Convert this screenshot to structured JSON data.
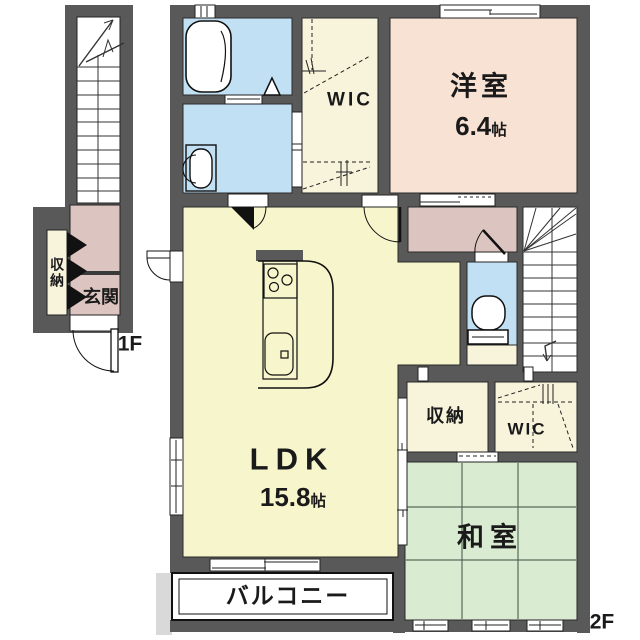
{
  "first_floor": {
    "floor_label": "1F",
    "entrance_label": "玄関",
    "storage_label": "収納"
  },
  "second_floor": {
    "floor_label": "2F",
    "western_room": {
      "name": "洋室",
      "size": "6.4",
      "size_unit": "帖"
    },
    "ldk": {
      "name": "LDK",
      "size": "15.8",
      "size_unit": "帖"
    },
    "japanese_room": {
      "name": "和室"
    },
    "balcony": {
      "name": "バルコニー"
    },
    "walk_in_closet_top": {
      "name": "WIC"
    },
    "walk_in_closet_right": {
      "name": "WIC"
    },
    "storage_label": "収納"
  },
  "colors": {
    "wall": "#595959",
    "water_rooms": "#c2e0f4",
    "ldk_floor": "#f7f5cc",
    "closet_floor": "#f8f4dc",
    "western_room_floor": "#f8e2d4",
    "hallway_floor": "#dcc5c1",
    "tatami": "#d9ebd1",
    "balcony_floor": "#ffffff"
  }
}
